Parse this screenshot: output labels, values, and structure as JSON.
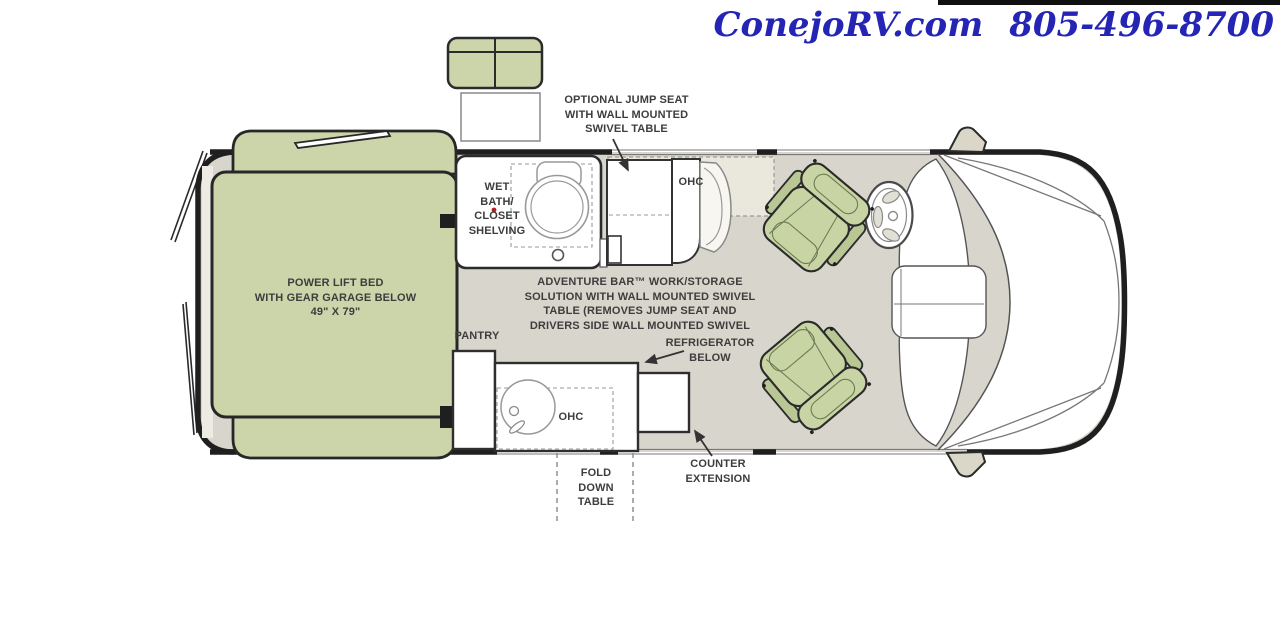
{
  "header": {
    "site": "ConejoRV.com",
    "phone": "805-496-8700"
  },
  "floorplan": {
    "labels": {
      "jump_seat": "OPTIONAL JUMP SEAT\nWITH WALL MOUNTED\nSWIVEL TABLE",
      "wet_bath": "WET\nBATH/\nCLOSET\nSHELVING",
      "ohc_bar": "OHC",
      "adventure_bar": "ADVENTURE BAR™ WORK/STORAGE\nSOLUTION WITH WALL MOUNTED SWIVEL\nTABLE (REMOVES JUMP SEAT AND\nDRIVERS SIDE WALL MOUNTED SWIVEL",
      "pantry": "PANTRY",
      "refrigerator": "REFRIGERATOR\nBELOW",
      "ohc_galley": "OHC",
      "fold_table": "FOLD\nDOWN\nTABLE",
      "counter_extension": "COUNTER\nEXTENSION",
      "bed": "POWER LIFT BED\nWITH GEAR GARAGE BELOW\n49\" X 79\""
    },
    "colors": {
      "accent_blue": "#2525b5",
      "floor": "#d8d6cc",
      "upholstery_green": "#ccd5aa",
      "highlight": "#eae8dc",
      "outline": "#1f1f1f"
    },
    "icons": [
      "jump-seat-icon",
      "toilet-icon",
      "sink-icon",
      "steering-wheel-icon",
      "captain-chair-icon",
      "mirror-icon",
      "arrow-icon"
    ]
  }
}
